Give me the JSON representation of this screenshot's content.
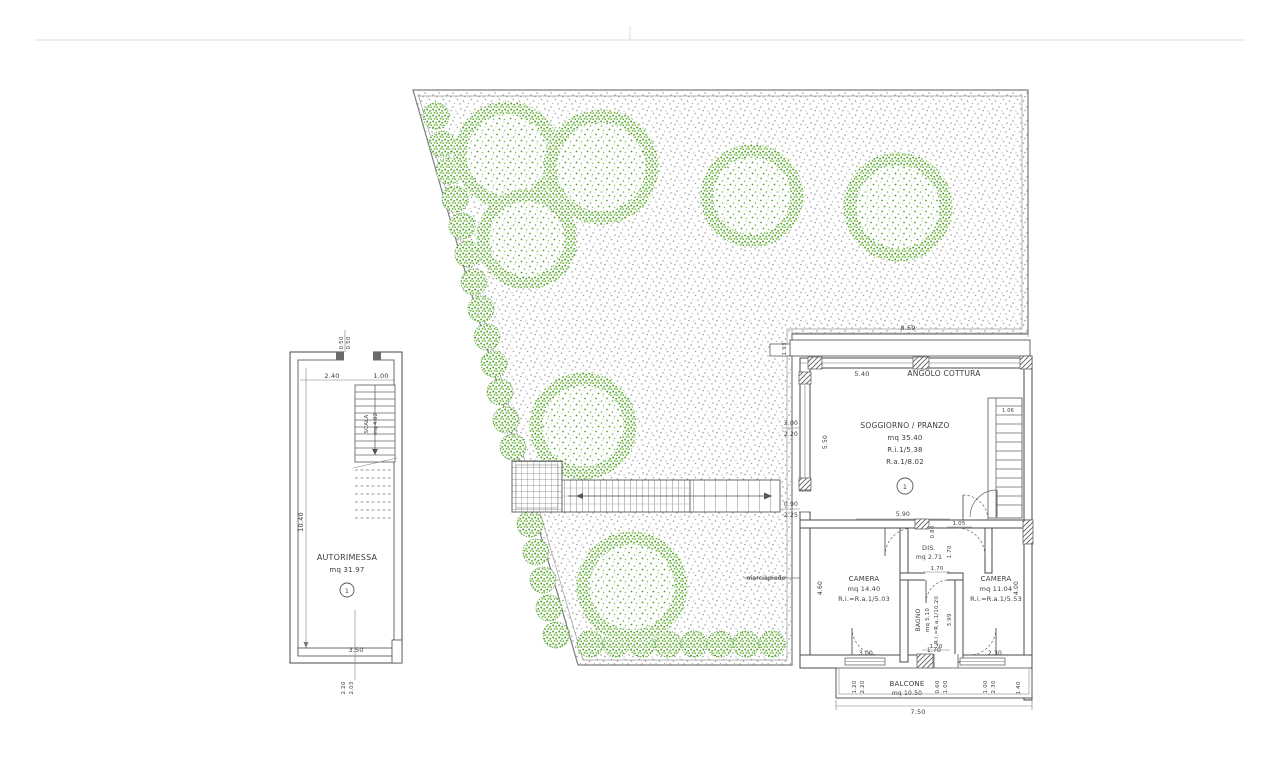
{
  "colors": {
    "tree_green": "#5aa832",
    "stipple_gray": "#9a9a9a",
    "wall_line": "#4a4a4a"
  },
  "garage": {
    "name": "AUTORIMESSA",
    "area": "mq 31.97",
    "unit_number": "1",
    "stair_label": "SCALA",
    "stair_area": "mq 4.02",
    "dims": {
      "top_offset_a": "0.50",
      "top_offset_b": "0.50",
      "top_left_w": "2.40",
      "top_right_w": "1.00",
      "left_h": "10.40",
      "bottom_w": "3.50",
      "bottom_offset_a": "2.20",
      "bottom_offset_b": "2.03"
    }
  },
  "garden": {
    "walkway_label": "marciapiede"
  },
  "main": {
    "terrace_w": "8.59",
    "terrace_d": "1.93",
    "kitchen_w": "5.40",
    "kitchen_label": "ANGOLO COTTURA",
    "living": {
      "label": "SOGGIORNO / PRANZO",
      "area": "mq 35.40",
      "ri": "R.i.1/5.38",
      "ra": "R.a.1/8.02",
      "unit_number": "1",
      "left_h": "5.50",
      "win_a": "3.00",
      "win_b": "2.20",
      "door_a": "0.90",
      "door_b": "2.25",
      "stair_w": "1.06"
    },
    "hall_w": "5.90",
    "pier_a": "0.80",
    "pier_b": "1.05",
    "dis": {
      "label": "DIS.",
      "area": "mq 2.71",
      "w": "1.70",
      "h": "1.70"
    },
    "camera_left": {
      "label": "CAMERA",
      "area": "mq 14.40",
      "ratio": "R.i.=R.a.1/5.03",
      "h": "4.60"
    },
    "camera_right": {
      "label": "CAMERA",
      "area": "mq 11.04",
      "ratio": "R.i.=R.a.1/5.53",
      "h": "4.00"
    },
    "bagno": {
      "label": "BAGNO",
      "area": "mq 5.10",
      "ratio": "R.i.=R.a.1/10.20",
      "w": "1.70",
      "h": "3.99"
    },
    "balcone": {
      "label": "BALCONE",
      "area": "mq 10.50",
      "total_w": "7.50",
      "d": "1.40",
      "win_left": "3.00",
      "door_mid": "1.70",
      "win_right": "2.30",
      "off_l1": "1.20",
      "off_l2": "2.20",
      "off_m1": "0.60",
      "off_m2": "1.00",
      "off_r1": "1.00",
      "off_r2": "2.30"
    }
  }
}
